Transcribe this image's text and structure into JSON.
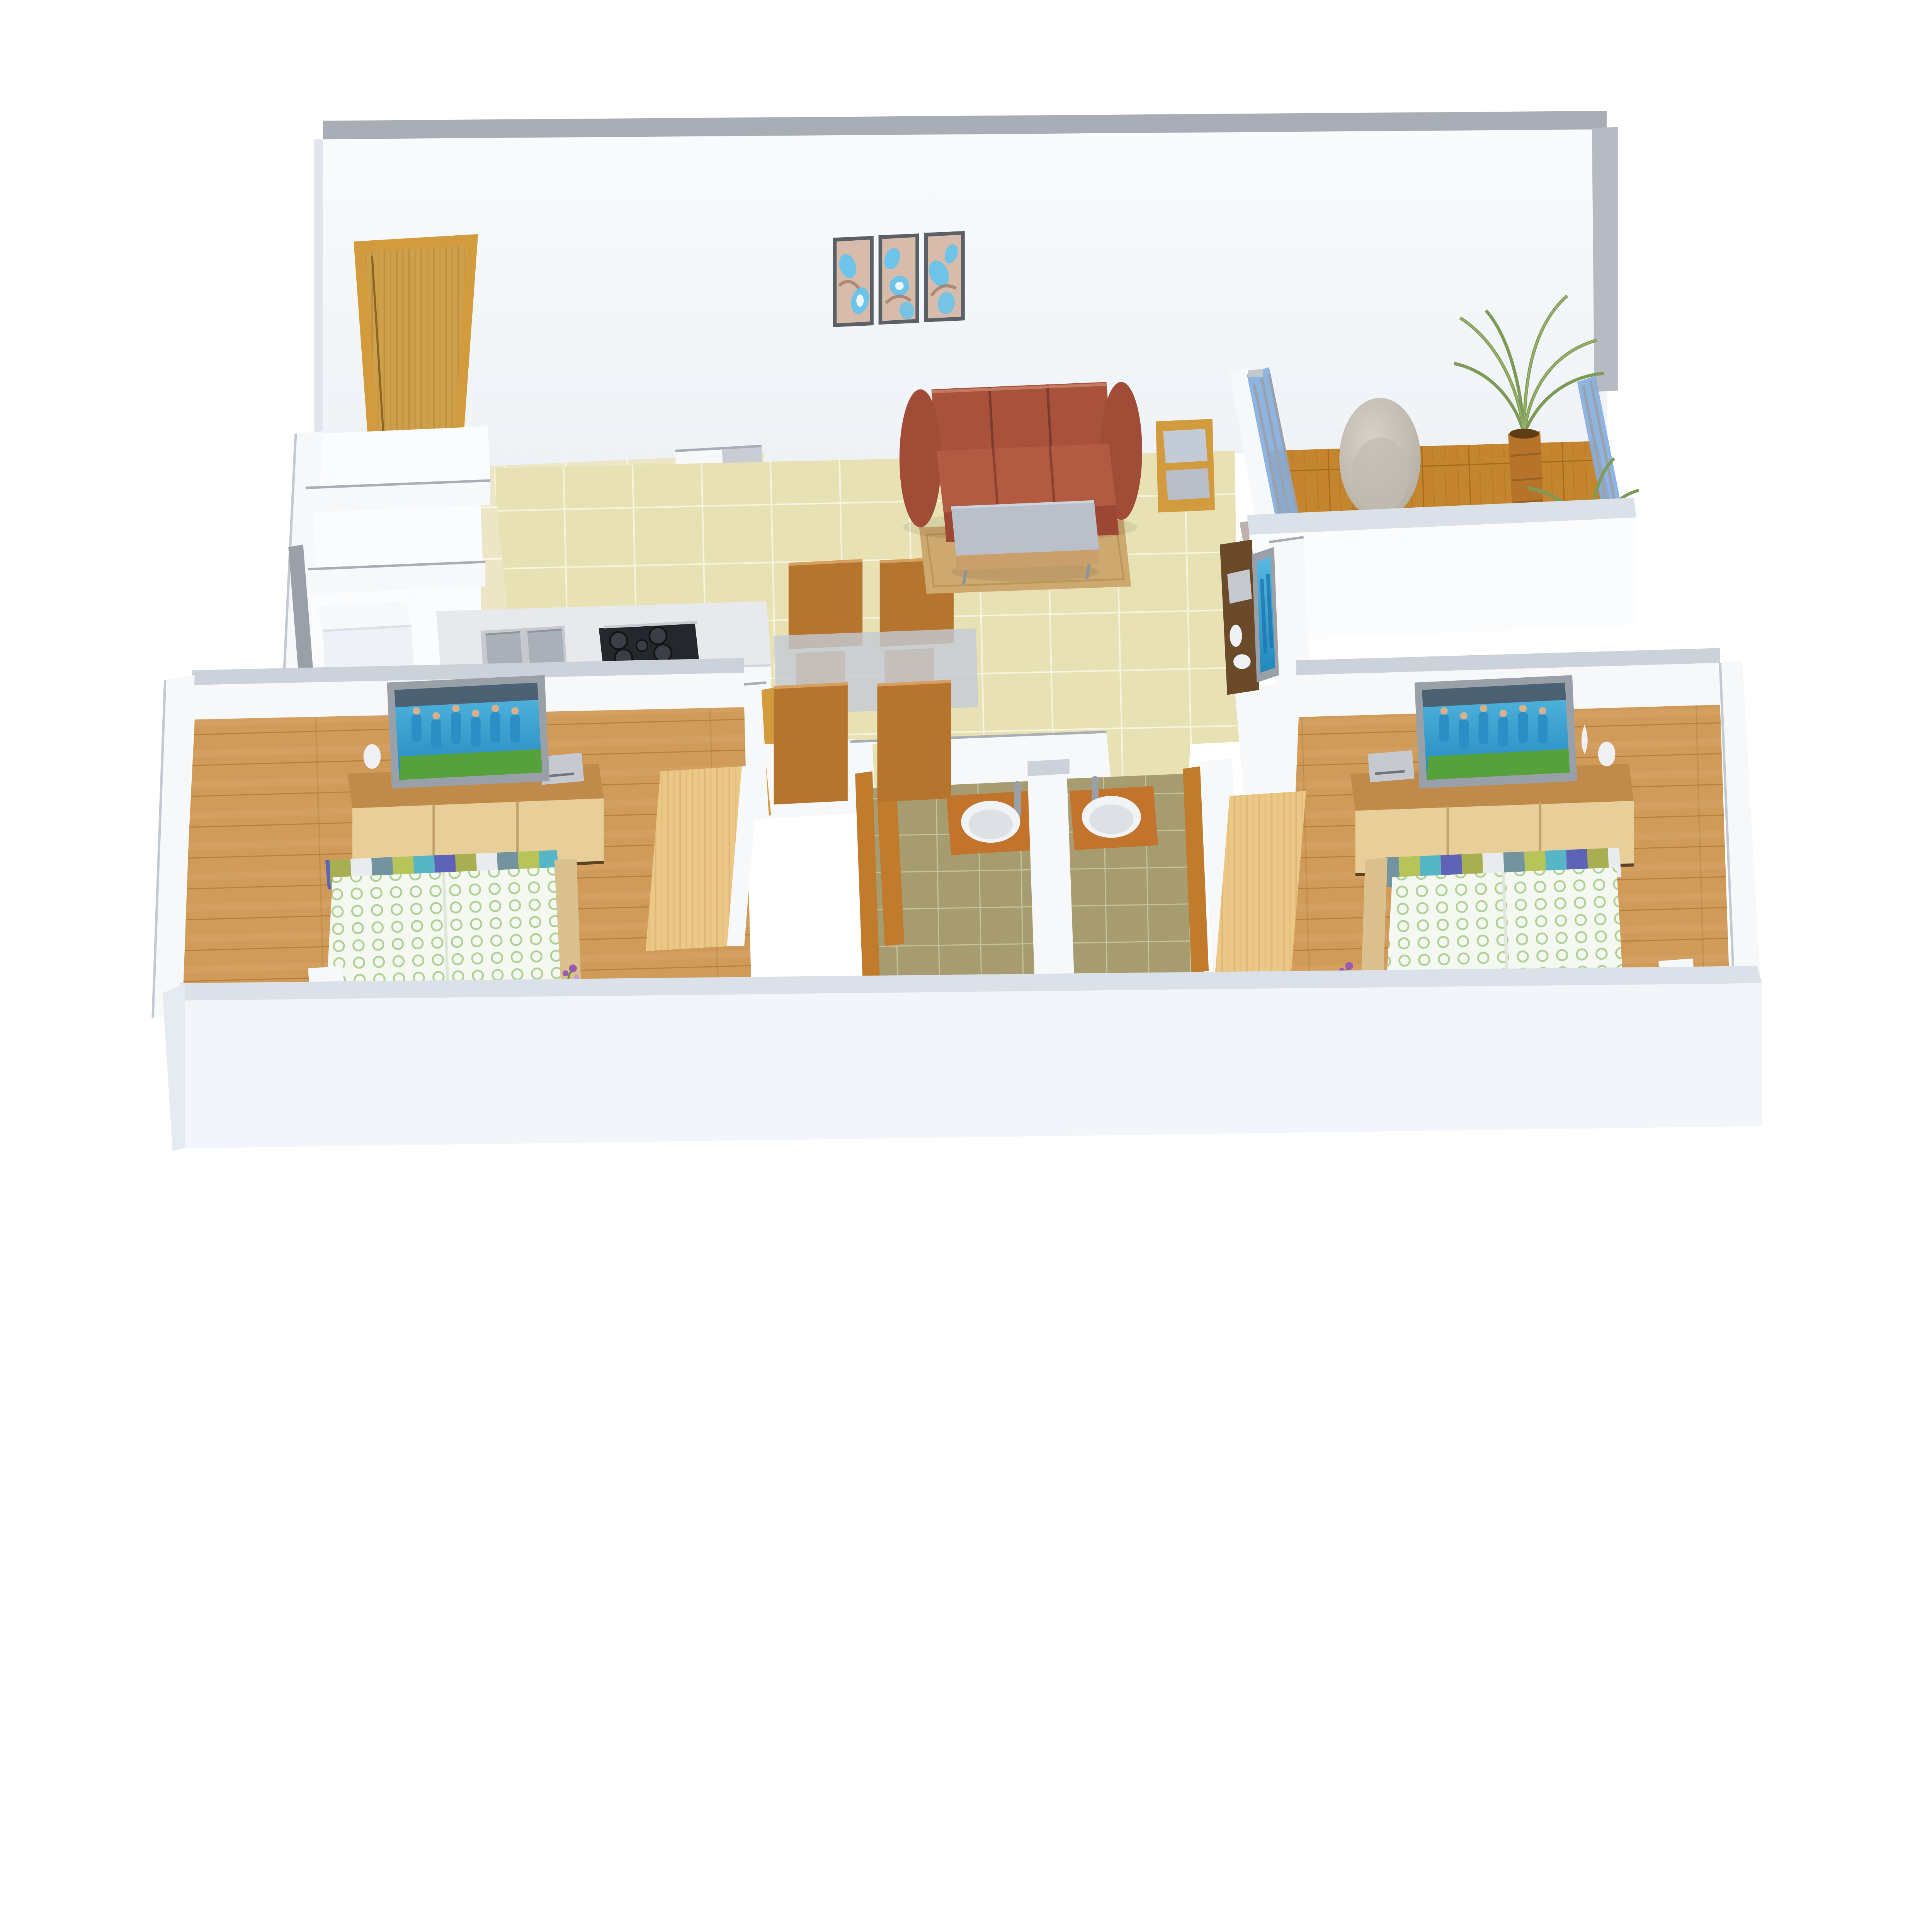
{
  "meta": {
    "description": "3D isometric top-down architectural rendering of a two-bedroom apartment floor plan, no visible text labels",
    "view": "axonometric cutaway with white section walls on a white plinth"
  },
  "colors": {
    "wall_face": "#f6f8fa",
    "wall_bright": "#fbfcfd",
    "wall_cap": "#a9aeb6",
    "wall_cap_light": "#ccd2da",
    "wall_cut": "#b6bbc3",
    "plinth_top": "#dbe1e9",
    "plinth_face": "#f2f6fa",
    "plinth_side": "#e6ebf2",
    "tile_living": "#e8e1b3",
    "tile_living_grout": "#f7f3dd",
    "tile_kitchen": "#ece6c6",
    "tile_kitchen_grout": "#fbf8ea",
    "tile_bath": "#a79b70",
    "tile_bath_grout": "#c9c19c",
    "wood_floor": "#d09a58",
    "wood_floor_line": "#b67f3f",
    "parquet": "#c5852e",
    "parquet_line": "#a76b1e",
    "door_wood": "#d29b3e",
    "door_wood_face": "#cfa04c",
    "door_wood_dark": "#8a6420",
    "bath_door_wood": "#c07c2c",
    "wardrobe_wood": "#ecc887",
    "console_top_wood": "#c08a4a",
    "console_door_wood": "#e8cf9a",
    "dark_console_wood": "#6b4a2a",
    "sofa_main": "#a8523c",
    "sofa_seat": "#b25a42",
    "sofa_front": "#9c4733",
    "sofa_dark": "#7c3a2b",
    "sofa_highlight": "#c47a62",
    "rug": "#cda86f",
    "table_gray": "#bac0ca",
    "table_wood_band": "#c9a06b",
    "chair_wood": "#b5752f",
    "chair_wood_light": "#d7a05f",
    "glass_table": "#c3cbd6",
    "glass_blue": "#86aede",
    "glass_gray": "#9aa0a8",
    "marble_counter": "#e7e9ed",
    "marble_gray": "#b9bdc7",
    "marble_gray_light": "#c9ccd4",
    "steel": "#c6cad0",
    "steel_dark": "#aab0b7",
    "hob_black": "#24272c",
    "burner_gray": "#3b3f45",
    "screen_blue": "#39a5d6",
    "player_blue": "#2b8ec5",
    "pitch_green": "#57a13c",
    "crowd_dark": "#4b5360",
    "white_obj": "#eef0f3",
    "egg_chair": "#c9c2b8",
    "cream_table": "#e9dcc0",
    "palm_green": "#7d9a57",
    "planter_wood": "#b5742a",
    "art_frame": "#5b6067",
    "art_bg": "#d8bcab",
    "art_blue": "#6ec3e8",
    "art_brown": "#8a5f4a",
    "basin_white": "#f1f3f6",
    "basin_shade": "#dde1e6",
    "bath_shelf_wood": "#c2742c",
    "bench_tan": "#d9c08c",
    "flower_purple": "#9a5ab0",
    "track_mauve": "#b3a5a1"
  },
  "scene": {
    "rooms": [
      {
        "name": "living-dining",
        "floor": "beige ceramic tile",
        "objects": [
          "three-seat leather sofa",
          "gray-top coffee table",
          "tan area rug",
          "two-tier wooden side table",
          "glass-top dining table",
          "four wooden dining chairs",
          "dark wood tv console",
          "wall tv",
          "dvd player",
          "white vases",
          "abstract triptych wall art"
        ]
      },
      {
        "name": "kitchen",
        "floor": "cream ceramic tile",
        "objects": [
          "marble counter",
          "double-bowl sink",
          "five-burner gas hob",
          "tall gray marble cabinet",
          "wooden door frame"
        ]
      },
      {
        "name": "balcony",
        "floor": "wood parquet deck",
        "objects": [
          "gray egg chair",
          "round cream side table",
          "tall wooden planter with palm",
          "second palm",
          "blue glass railing",
          "sliding glass door",
          "white parapet"
        ]
      },
      {
        "name": "entrance-foyer",
        "objects": [
          "wooden entry door"
        ]
      },
      {
        "name": "utility",
        "objects": [
          "washing machine",
          "gray wall rail"
        ]
      },
      {
        "name": "bathroom-left",
        "floor": "olive tile",
        "objects": [
          "wooden vanity shelf",
          "round vessel basin",
          "tall chrome faucet",
          "wooden door"
        ]
      },
      {
        "name": "bathroom-right",
        "floor": "olive tile",
        "objects": [
          "wooden vanity shelf",
          "round vessel basin",
          "tall chrome faucet",
          "wooden door frame"
        ]
      },
      {
        "name": "bedroom-left",
        "floor": "warm wood planks",
        "objects": [
          "bed with white-green duvet and striped throw",
          "bedside bench",
          "white nightstand",
          "purple flowers",
          "wooden tv cabinet",
          "flat tv",
          "dvd player",
          "white vases",
          "light wood wardrobe"
        ]
      },
      {
        "name": "bedroom-right",
        "floor": "warm wood planks",
        "objects": [
          "bed with white-green duvet and striped throw",
          "bedside bench",
          "white nightstand",
          "purple flowers",
          "wooden tv cabinet",
          "flat tv",
          "dvd player",
          "white vases",
          "light wood wardrobe"
        ]
      }
    ],
    "tv_screen_content": "cricket team celebrating in blue jerseys on green field"
  }
}
